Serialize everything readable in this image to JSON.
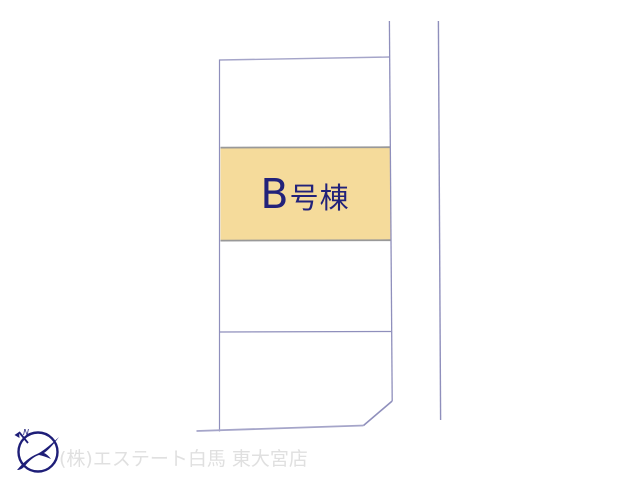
{
  "map": {
    "highlight_label": "B号棟",
    "colors": {
      "highlight": "#F5DB9B",
      "label": "#22227A",
      "outline": "#8F8FBC",
      "outline_light": "#A5A5C9",
      "divider_gray": "#999999"
    }
  },
  "footer": {
    "company": "(株)エステート白馬 東大宮店",
    "logo_letter": "N",
    "colors": {
      "logo_navy": "#1E1E78",
      "text_gray": "#E0E0E0"
    }
  }
}
